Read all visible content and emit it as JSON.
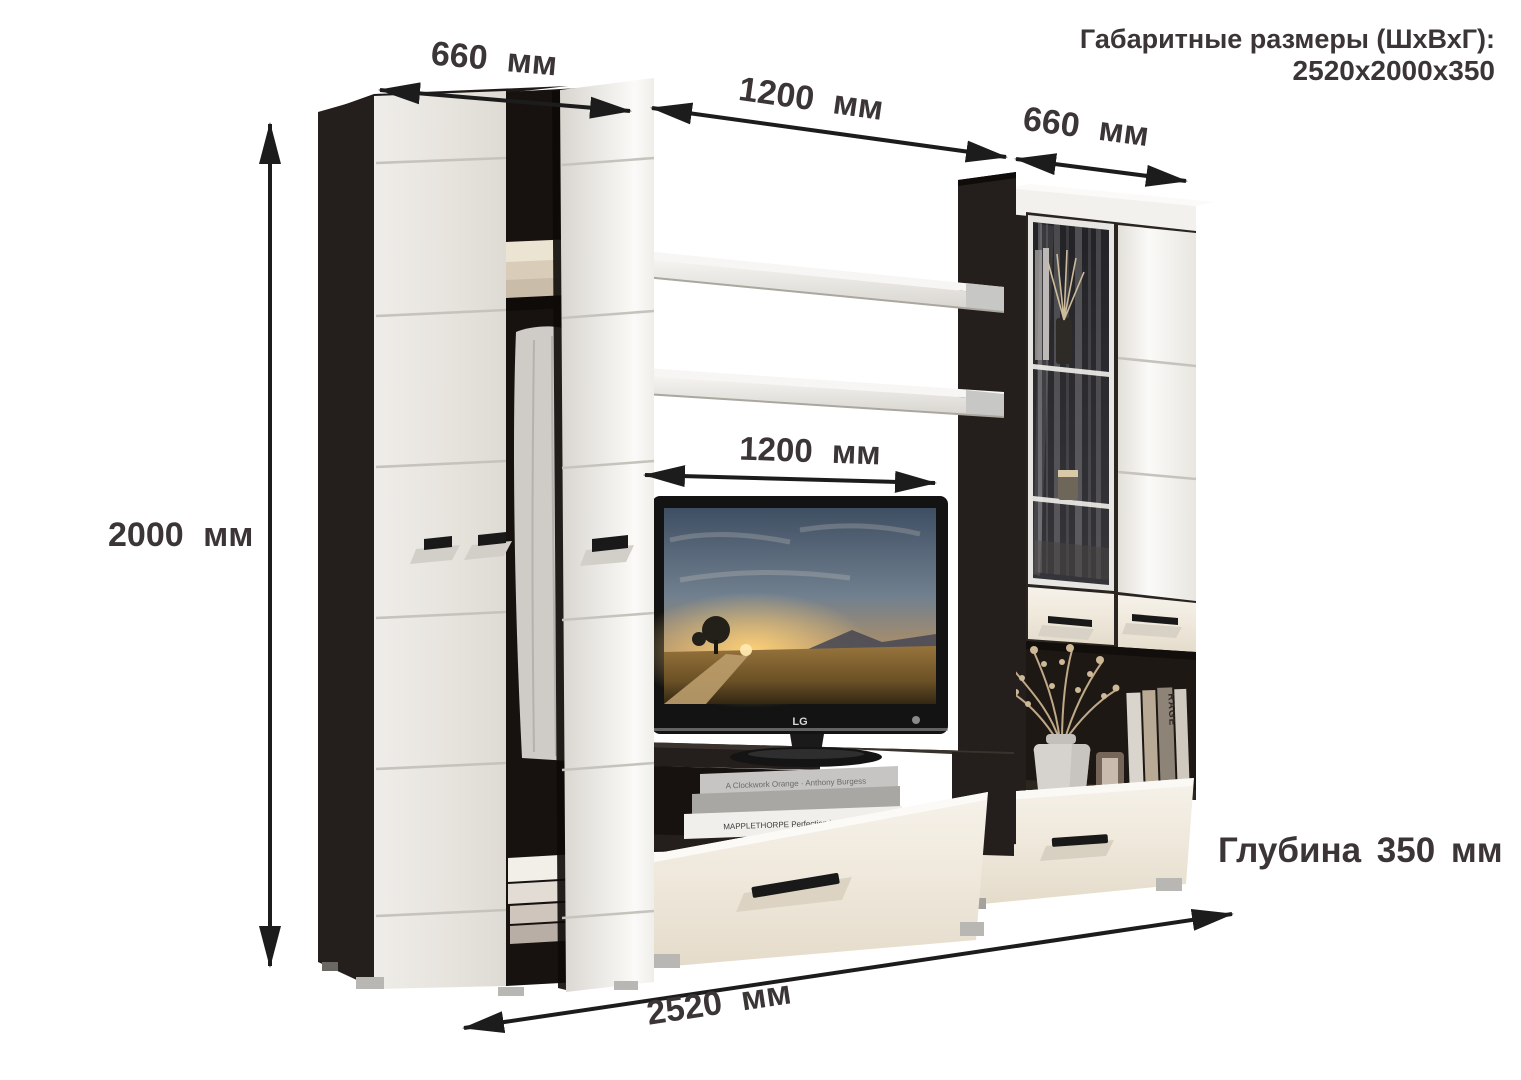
{
  "header": {
    "line1": "Габаритные размеры (ШхВхГ):",
    "line2": "2520x2000x350"
  },
  "dims": {
    "left_section_width": "660 мм",
    "middle_section_width": "1200 мм",
    "right_section_width": "660 мм",
    "height": "2000 мм",
    "tv_niche_width": "1200 мм",
    "total_width": "2520 мм",
    "depth": "Глубина 350 мм"
  },
  "tv": {
    "brand": "LG"
  },
  "decor": {
    "book_stack_top": "A Clockwork Orange · Anthony Burgess",
    "book_stack_bottom": "MAPPLETHORPE Perfection in Form",
    "shelf_book": "RAGE"
  },
  "colors": {
    "background": "#ffffff",
    "annotation_text": "#3b3535",
    "arrow": "#1c1c1c",
    "wenge_dark": "#241f1c",
    "wenge_deep": "#17120f",
    "gloss_white": "#edebe6",
    "cream_drawer": "#efe8dc",
    "metal": "#b9b7b3"
  }
}
